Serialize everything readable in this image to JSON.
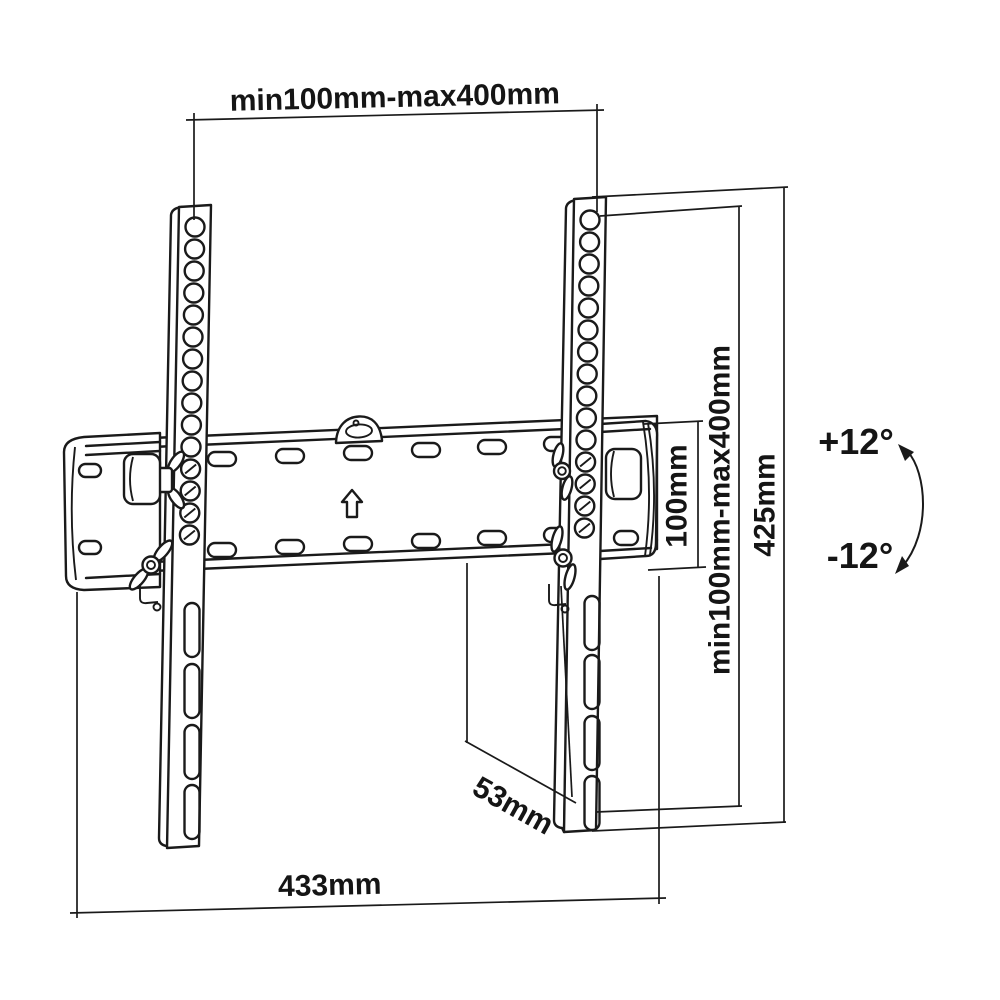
{
  "dimensions": {
    "vesa_horizontal": "min100mm-max400mm",
    "vesa_vertical": "min100mm-max400mm",
    "plate_height": "100mm",
    "bracket_height": "425mm",
    "bracket_width": "433mm",
    "mount_depth": "53mm"
  },
  "tilt": {
    "up": "+12°",
    "down": "-12°"
  },
  "colors": {
    "line": "#1a1a1a",
    "background": "#ffffff"
  }
}
